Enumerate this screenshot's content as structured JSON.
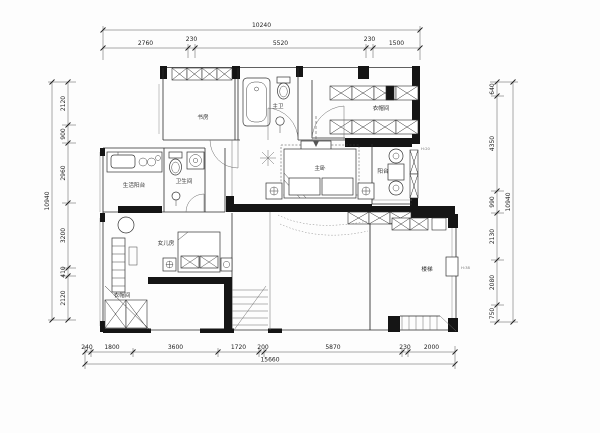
{
  "plan": {
    "rooms": {
      "study": "书房",
      "master_bath": "主卫",
      "closet_top": "衣帽间",
      "service_balcony": "生活阳台",
      "bathroom": "卫生间",
      "master_bedroom": "主卧",
      "balcony": "阳台",
      "daughter_room": "女儿房",
      "closet_bottom": "衣帽间",
      "stair_room": "楼梯"
    },
    "annotations": {
      "balcony_note": "H:20",
      "window_note": "H:38"
    },
    "dimensions": {
      "top": {
        "total": "10240",
        "segments": [
          "2760",
          "230",
          "5520",
          "230",
          "1500"
        ]
      },
      "bottom": {
        "total": "15660",
        "segments": [
          "240",
          "1800",
          "3600",
          "1720",
          "200",
          "5870",
          "230",
          "2000"
        ]
      },
      "left": {
        "total": "10940",
        "segments": [
          "2120",
          "900",
          "2960",
          "3200",
          "410",
          "2120"
        ]
      },
      "right": {
        "total": "10940",
        "segments": [
          "640",
          "4350",
          "990",
          "2130",
          "2080",
          "750"
        ]
      }
    }
  }
}
